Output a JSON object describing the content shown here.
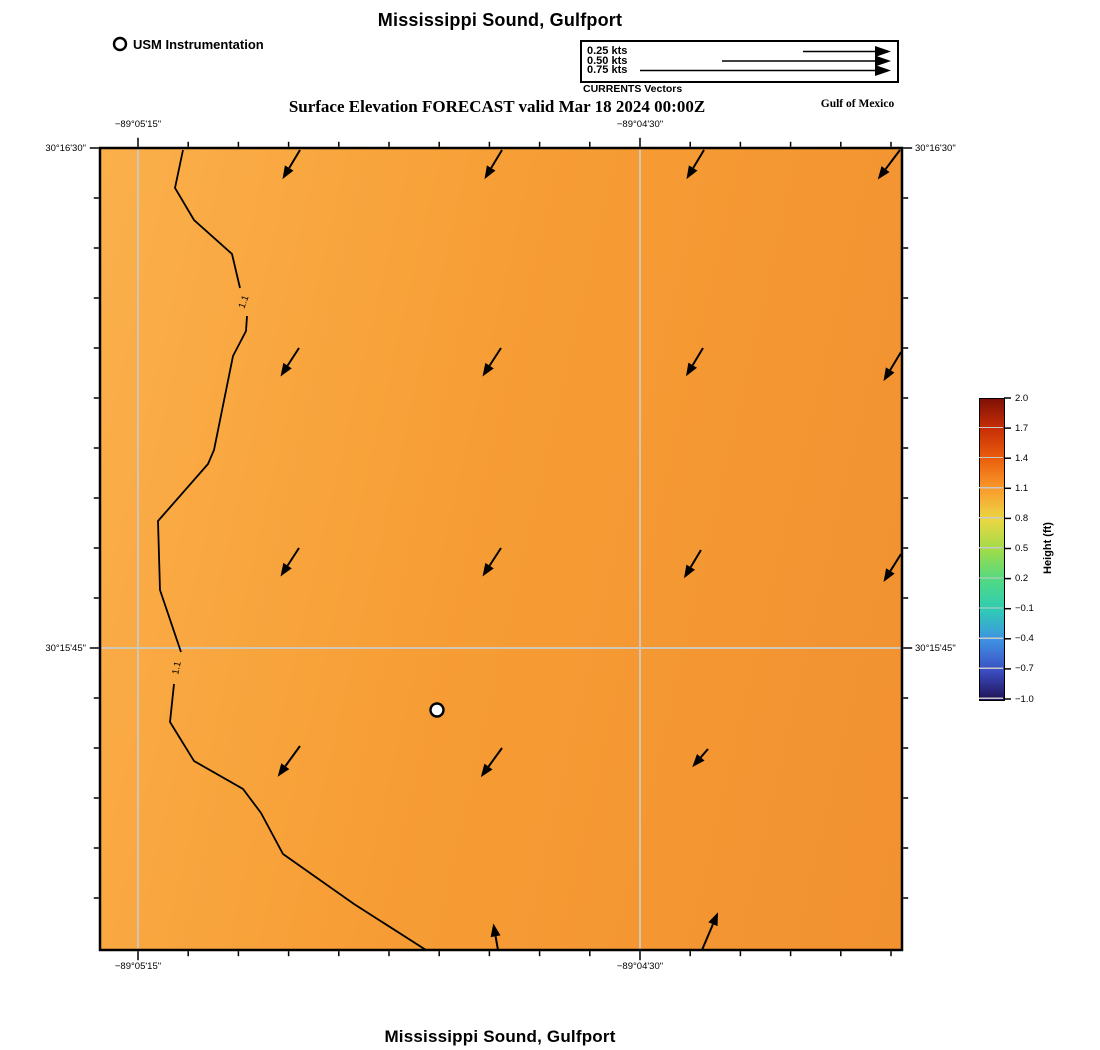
{
  "titles": {
    "top": "Mississippi Sound, Gulfport",
    "subtitle": "Surface Elevation FORECAST valid Mar 18 2024 00:00Z",
    "bottom": "Mississippi Sound, Gulfport",
    "region_label": "Gulf of Mexico"
  },
  "legend": {
    "instrumentation_label": "USM Instrumentation",
    "vectors_caption": "CURRENTS Vectors",
    "speeds": [
      {
        "label": "0.25 kts",
        "y": 51.5,
        "x1": 803
      },
      {
        "label": "0.50 kts",
        "y": 61.0,
        "x1": 722
      },
      {
        "label": "0.75 kts",
        "y": 70.5,
        "x1": 640
      }
    ],
    "arrow_tip_x": 891
  },
  "axes": {
    "top": [
      {
        "label": "−89°05'15\"",
        "x": 138
      },
      {
        "label": "−89°04'30\"",
        "x": 640
      }
    ],
    "bottom": [
      {
        "label": "−89°05'15\"",
        "x": 138
      },
      {
        "label": "−89°04'30\"",
        "x": 640
      }
    ],
    "left": [
      {
        "label": "30°16'30\"",
        "y": 148
      },
      {
        "label": "30°15'45\"",
        "y": 648
      }
    ],
    "right": [
      {
        "label": "30°16'30\"",
        "y": 148
      },
      {
        "label": "30°15'45\"",
        "y": 648
      }
    ]
  },
  "map": {
    "contour_label": "1.1",
    "fill_gradient": [
      "#fbb04b",
      "#f79d35",
      "#f19130"
    ],
    "gridline_color": "#cfc8b6",
    "marker": {
      "x": 437,
      "y": 710
    },
    "legend_marker": {
      "x": 120,
      "y": 44
    }
  },
  "colorbar": {
    "label": "Height (ft)",
    "ticks": [
      "2.0",
      "1.7",
      "1.4",
      "1.1",
      "0.8",
      "0.5",
      "0.2",
      "−0.1",
      "−0.4",
      "−0.7",
      "−1.0"
    ],
    "gradient_stops": [
      "#801007",
      "#c82f05",
      "#ea5f0e",
      "#f99c2c",
      "#ebd743",
      "#a0dc48",
      "#52d983",
      "#2fccb4",
      "#3f92e2",
      "#3b50c3",
      "#201256"
    ]
  },
  "chart_data": {
    "type": "heatmap",
    "subtype": "contour-vector-forecast-map",
    "title": "Mississippi Sound, Gulfport",
    "subtitle": "Surface Elevation FORECAST valid Mar 18 2024 00:00Z",
    "field": "Surface elevation (ft), approx 1.1–1.3 over domain",
    "contour_levels": [
      1.1
    ],
    "x_axis": {
      "label": "longitude",
      "tick_labels": [
        "−89°05'15\"",
        "−89°04'30\""
      ]
    },
    "y_axis": {
      "label": "latitude",
      "tick_labels": [
        "30°16'30\"",
        "30°15'45\""
      ]
    },
    "colorbar": {
      "label": "Height (ft)",
      "min": -1.0,
      "max": 2.0,
      "step": 0.3
    },
    "vector_legend_kts": [
      0.25,
      0.5,
      0.75
    ],
    "grid_on": true,
    "vectors": [
      {
        "x": 300,
        "y": 150,
        "a": 121,
        "l": 34
      },
      {
        "x": 502,
        "y": 150,
        "a": 121,
        "l": 34
      },
      {
        "x": 704,
        "y": 150,
        "a": 121,
        "l": 34
      },
      {
        "x": 900,
        "y": 150,
        "a": 127,
        "l": 37
      },
      {
        "x": 299,
        "y": 348,
        "a": 123,
        "l": 34
      },
      {
        "x": 501,
        "y": 348,
        "a": 123,
        "l": 34
      },
      {
        "x": 703,
        "y": 348,
        "a": 121,
        "l": 33
      },
      {
        "x": 901,
        "y": 352,
        "a": 121,
        "l": 34
      },
      {
        "x": 299,
        "y": 548,
        "a": 123,
        "l": 34
      },
      {
        "x": 501,
        "y": 548,
        "a": 123,
        "l": 34
      },
      {
        "x": 701,
        "y": 550,
        "a": 121,
        "l": 33
      },
      {
        "x": 901,
        "y": 554,
        "a": 122,
        "l": 33
      },
      {
        "x": 300,
        "y": 746,
        "a": 126,
        "l": 38
      },
      {
        "x": 502,
        "y": 748,
        "a": 126,
        "l": 36
      },
      {
        "x": 708,
        "y": 749,
        "a": 131,
        "l": 24
      },
      {
        "x": 498,
        "y": 950,
        "a": 260,
        "l": 27
      },
      {
        "x": 702,
        "y": 950,
        "a": 293,
        "l": 41
      }
    ],
    "contour_segments": [
      [
        [
          183,
          150
        ],
        [
          175,
          188
        ],
        [
          194,
          220
        ],
        [
          232,
          254
        ],
        [
          240,
          288
        ]
      ],
      [
        [
          247,
          316
        ],
        [
          246,
          331
        ],
        [
          233,
          356
        ],
        [
          214,
          450
        ],
        [
          208,
          464
        ],
        [
          158,
          521
        ],
        [
          160,
          590
        ],
        [
          181,
          652
        ]
      ],
      [
        [
          174,
          684
        ],
        [
          170,
          722
        ],
        [
          194,
          761
        ],
        [
          243,
          789
        ],
        [
          261,
          813
        ],
        [
          283,
          854
        ],
        [
          354,
          904
        ],
        [
          426,
          950
        ]
      ]
    ],
    "contour_label_pos": [
      {
        "x": 244,
        "y": 302,
        "rot": -70
      },
      {
        "x": 177,
        "y": 668,
        "rot": -78
      }
    ]
  }
}
